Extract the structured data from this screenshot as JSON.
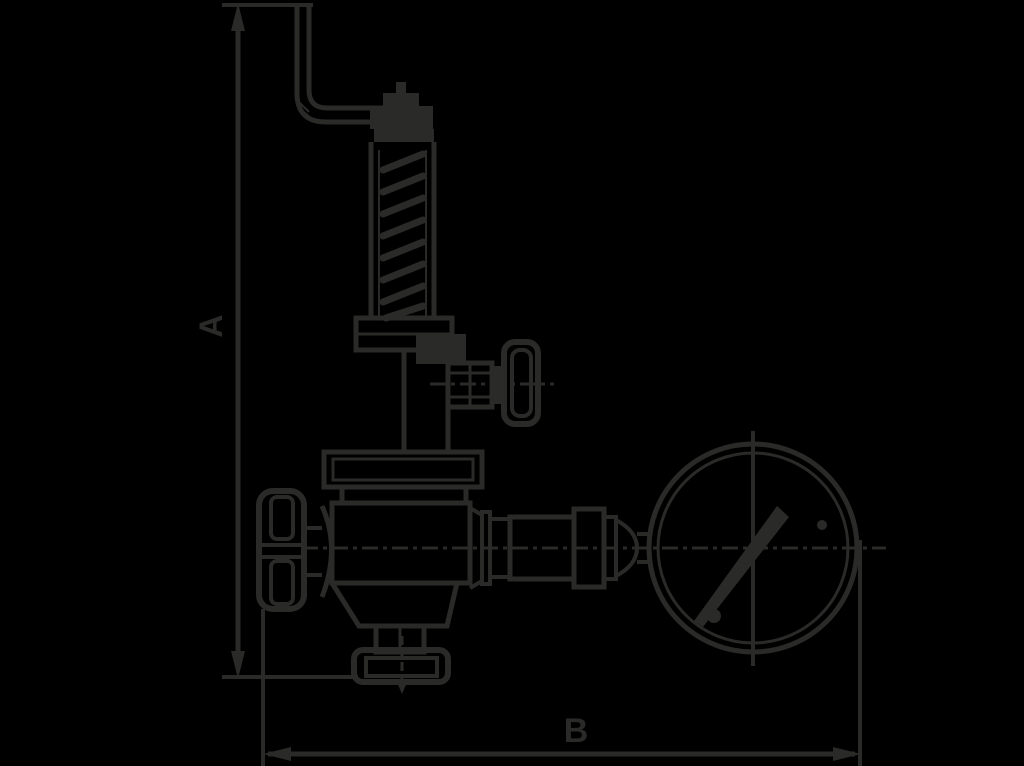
{
  "page": {
    "background_color": "#000000"
  },
  "drawing": {
    "line_color": "#2a2a28",
    "dimension_labels": {
      "vertical": "A",
      "horizontal": "B"
    }
  }
}
